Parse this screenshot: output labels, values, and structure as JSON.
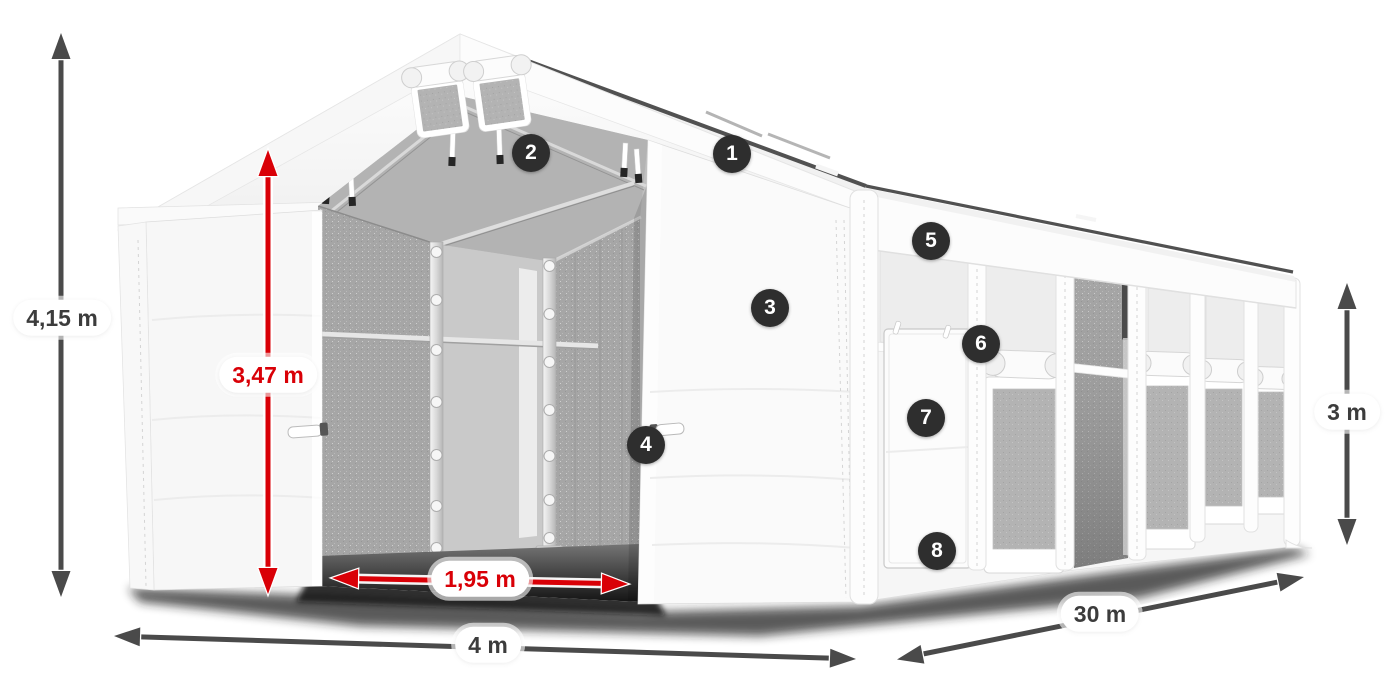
{
  "page": {
    "description": "Dimensioned illustration of a white storage tent with numbered feature markers",
    "background": "#ffffff"
  },
  "colors": {
    "accent_red": "#d90007",
    "arrow_gray": "#4a4a4a",
    "badge_background": "#2e2e2e",
    "badge_text": "#ffffff",
    "label_text": "#3c3c3c",
    "label_background": "#ffffff",
    "tent_white": "#f7f7f7",
    "interior_gray": "#a7a7a7"
  },
  "dimensions": {
    "total_height": "4,15 m",
    "inner_clearance_height": "3,47 m",
    "entrance_width": "1,95 m",
    "width": "4 m",
    "length": "30 m",
    "side_wall_height": "3 m"
  },
  "feature_markers": [
    "1",
    "2",
    "3",
    "4",
    "5",
    "6",
    "7",
    "8"
  ]
}
